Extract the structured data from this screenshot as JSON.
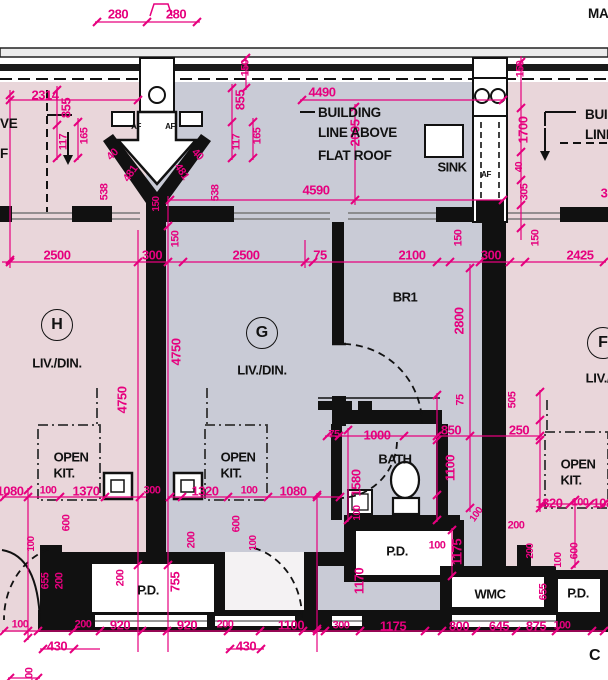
{
  "page": {
    "top_right_fragment": "MA",
    "corner_letter": "C"
  },
  "notes": {
    "building_line_note": [
      "BUILDING",
      "LINE ABOVE",
      "FLAT ROOF"
    ],
    "right_edge_note": [
      "BUIL",
      "LINE"
    ],
    "left_edge_note_1": "VE",
    "left_edge_note_2": "F"
  },
  "units": [
    {
      "letter": "H",
      "bx": 57,
      "by": 325,
      "room": "LIV./DIN.",
      "rx": 57,
      "ry": 363
    },
    {
      "letter": "G",
      "bx": 262,
      "by": 333,
      "room": "LIV./DIN.",
      "rx": 262,
      "ry": 370
    },
    {
      "letter": "F",
      "bx": 603,
      "by": 343,
      "room": "LIV./",
      "rx": 598,
      "ry": 378
    }
  ],
  "colors": {
    "dimension_pink": "#e6007e",
    "wall_black": "#111111",
    "floor_pink": "#e9d6da",
    "floor_gray": "#c9cbd6",
    "window_gray": "#777777"
  },
  "labels": [
    {
      "t": "280",
      "x": 118,
      "y": 14
    },
    {
      "t": "280",
      "x": 176,
      "y": 14
    },
    {
      "t": "2314",
      "x": 45,
      "y": 95
    },
    {
      "t": "4490",
      "x": 322,
      "y": 92
    },
    {
      "t": "855",
      "x": 66,
      "y": 108,
      "r": -90
    },
    {
      "t": "855",
      "x": 240,
      "y": 100,
      "r": -90
    },
    {
      "t": "150",
      "x": 246,
      "y": 68,
      "r": -90,
      "s": 11
    },
    {
      "t": "150",
      "x": 521,
      "y": 69,
      "r": -90,
      "s": 11
    },
    {
      "t": "117",
      "x": 64,
      "y": 142,
      "r": -90,
      "s": 11
    },
    {
      "t": "165",
      "x": 85,
      "y": 136,
      "r": -90,
      "s": 11
    },
    {
      "t": "117",
      "x": 237,
      "y": 142,
      "r": -90,
      "s": 11
    },
    {
      "t": "165",
      "x": 258,
      "y": 136,
      "r": -90,
      "s": 11
    },
    {
      "t": "40",
      "x": 113,
      "y": 155,
      "r": -45,
      "s": 11
    },
    {
      "t": "481",
      "x": 131,
      "y": 174,
      "r": -55,
      "s": 11
    },
    {
      "t": "538",
      "x": 105,
      "y": 192,
      "r": -90,
      "s": 11
    },
    {
      "t": "40",
      "x": 197,
      "y": 155,
      "r": 45,
      "s": 11
    },
    {
      "t": "481",
      "x": 181,
      "y": 172,
      "r": 55,
      "s": 11
    },
    {
      "t": "538",
      "x": 216,
      "y": 193,
      "r": -90,
      "s": 11
    },
    {
      "t": "150",
      "x": 157,
      "y": 204,
      "r": -90,
      "s": 10
    },
    {
      "t": "2005",
      "x": 355,
      "y": 133,
      "r": -90
    },
    {
      "t": "1700",
      "x": 523,
      "y": 130,
      "r": -90
    },
    {
      "t": "40",
      "x": 520,
      "y": 167,
      "r": -90,
      "s": 10
    },
    {
      "t": "305",
      "x": 525,
      "y": 192,
      "r": -90,
      "s": 11
    },
    {
      "t": "3",
      "x": 604,
      "y": 193
    },
    {
      "t": "4590",
      "x": 316,
      "y": 190
    },
    {
      "t": "2500",
      "x": 57,
      "y": 255
    },
    {
      "t": "300",
      "x": 152,
      "y": 255
    },
    {
      "t": "150",
      "x": 176,
      "y": 239,
      "r": -90,
      "s": 11
    },
    {
      "t": "2500",
      "x": 246,
      "y": 255
    },
    {
      "t": "75",
      "x": 320,
      "y": 255
    },
    {
      "t": "2100",
      "x": 412,
      "y": 255
    },
    {
      "t": "300",
      "x": 491,
      "y": 255
    },
    {
      "t": "150",
      "x": 459,
      "y": 238,
      "r": -90,
      "s": 11
    },
    {
      "t": "150",
      "x": 536,
      "y": 238,
      "r": -90,
      "s": 11
    },
    {
      "t": "2425",
      "x": 580,
      "y": 255
    },
    {
      "t": "4750",
      "x": 122,
      "y": 400,
      "r": -90
    },
    {
      "t": "4750",
      "x": 176,
      "y": 352,
      "r": -90
    },
    {
      "t": "2800",
      "x": 459,
      "y": 321,
      "r": -90
    },
    {
      "t": "75",
      "x": 461,
      "y": 400,
      "r": -90,
      "s": 11
    },
    {
      "t": "850",
      "x": 451,
      "y": 430
    },
    {
      "t": "250",
      "x": 519,
      "y": 430
    },
    {
      "t": "75",
      "x": 334,
      "y": 435,
      "s": 11
    },
    {
      "t": "1000",
      "x": 377,
      "y": 435
    },
    {
      "t": "1100",
      "x": 450,
      "y": 468,
      "r": -90
    },
    {
      "t": "1580",
      "x": 356,
      "y": 483,
      "r": -90
    },
    {
      "t": "505",
      "x": 513,
      "y": 400,
      "r": -90,
      "s": 11
    },
    {
      "t": "1080",
      "x": 10,
      "y": 491
    },
    {
      "t": "100",
      "x": 48,
      "y": 491,
      "s": 11
    },
    {
      "t": "1370",
      "x": 86,
      "y": 491
    },
    {
      "t": "300",
      "x": 152,
      "y": 491,
      "s": 11
    },
    {
      "t": "1320",
      "x": 205,
      "y": 491
    },
    {
      "t": "100",
      "x": 249,
      "y": 491,
      "s": 11
    },
    {
      "t": "1080",
      "x": 293,
      "y": 491
    },
    {
      "t": "1320",
      "x": 549,
      "y": 503
    },
    {
      "t": "100",
      "x": 580,
      "y": 503,
      "s": 11
    },
    {
      "t": "1080",
      "x": 606,
      "y": 503
    },
    {
      "t": "600",
      "x": 67,
      "y": 523,
      "r": -90,
      "s": 11
    },
    {
      "t": "100",
      "x": 32,
      "y": 544,
      "r": -90,
      "s": 10
    },
    {
      "t": "655",
      "x": 46,
      "y": 581,
      "r": -90,
      "s": 11
    },
    {
      "t": "200",
      "x": 60,
      "y": 581,
      "r": -90,
      "s": 11
    },
    {
      "t": "200",
      "x": 121,
      "y": 578,
      "r": -90,
      "s": 11
    },
    {
      "t": "755",
      "x": 175,
      "y": 582,
      "r": -90
    },
    {
      "t": "200",
      "x": 192,
      "y": 540,
      "r": -90,
      "s": 11
    },
    {
      "t": "600",
      "x": 237,
      "y": 524,
      "r": -90,
      "s": 11
    },
    {
      "t": "100",
      "x": 254,
      "y": 543,
      "r": -90,
      "s": 10
    },
    {
      "t": "100",
      "x": 358,
      "y": 513,
      "r": -90,
      "s": 10
    },
    {
      "t": "1170",
      "x": 359,
      "y": 581,
      "r": -90
    },
    {
      "t": "100",
      "x": 437,
      "y": 546,
      "s": 11
    },
    {
      "t": "1175",
      "x": 457,
      "y": 552,
      "r": -90
    },
    {
      "t": "100",
      "x": 477,
      "y": 515,
      "r": -55,
      "s": 10
    },
    {
      "t": "200",
      "x": 516,
      "y": 526,
      "s": 11
    },
    {
      "t": "200",
      "x": 531,
      "y": 551,
      "r": -90,
      "s": 10
    },
    {
      "t": "655",
      "x": 544,
      "y": 592,
      "r": -90,
      "s": 11
    },
    {
      "t": "100",
      "x": 559,
      "y": 560,
      "r": -90,
      "s": 10
    },
    {
      "t": "600",
      "x": 575,
      "y": 551,
      "r": -90,
      "s": 11
    },
    {
      "t": "100",
      "x": 20,
      "y": 625,
      "s": 11
    },
    {
      "t": "200",
      "x": 83,
      "y": 625,
      "s": 11
    },
    {
      "t": "920",
      "x": 120,
      "y": 625
    },
    {
      "t": "920",
      "x": 187,
      "y": 625
    },
    {
      "t": "200",
      "x": 225,
      "y": 625,
      "s": 11
    },
    {
      "t": "1100",
      "x": 291,
      "y": 625
    },
    {
      "t": "300",
      "x": 341,
      "y": 626,
      "s": 11
    },
    {
      "t": "1175",
      "x": 393,
      "y": 626
    },
    {
      "t": "800",
      "x": 459,
      "y": 626
    },
    {
      "t": "645",
      "x": 499,
      "y": 626
    },
    {
      "t": "875",
      "x": 536,
      "y": 626
    },
    {
      "t": "100",
      "x": 562,
      "y": 626,
      "s": 11
    },
    {
      "t": "430",
      "x": 57,
      "y": 646
    },
    {
      "t": "430",
      "x": 246,
      "y": 646
    },
    {
      "t": "100",
      "x": 30,
      "y": 676,
      "r": -90,
      "s": 11
    },
    {
      "t": "AF",
      "x": 136,
      "y": 127,
      "c": "k",
      "s": 8
    },
    {
      "t": "AF",
      "x": 170,
      "y": 127,
      "c": "k",
      "s": 8
    },
    {
      "t": "AF",
      "x": 486,
      "y": 175,
      "c": "k",
      "s": 8
    },
    {
      "t": "SINK",
      "x": 452,
      "y": 167,
      "c": "k"
    },
    {
      "t": "BR1",
      "x": 405,
      "y": 297,
      "c": "k"
    },
    {
      "t": "OPEN",
      "x": 71,
      "y": 457,
      "c": "k"
    },
    {
      "t": "KIT.",
      "x": 64,
      "y": 473,
      "c": "k"
    },
    {
      "t": "OPEN",
      "x": 238,
      "y": 457,
      "c": "k"
    },
    {
      "t": "KIT.",
      "x": 231,
      "y": 473,
      "c": "k"
    },
    {
      "t": "OPEN",
      "x": 578,
      "y": 464,
      "c": "k"
    },
    {
      "t": "KIT.",
      "x": 571,
      "y": 480,
      "c": "k"
    },
    {
      "t": "BATH",
      "x": 395,
      "y": 459,
      "c": "k"
    },
    {
      "t": "P.D.",
      "x": 148,
      "y": 590,
      "c": "k"
    },
    {
      "t": "P.D.",
      "x": 397,
      "y": 551,
      "c": "k"
    },
    {
      "t": "WMC",
      "x": 490,
      "y": 594,
      "c": "k"
    },
    {
      "t": "P.D.",
      "x": 578,
      "y": 593,
      "c": "k"
    }
  ]
}
